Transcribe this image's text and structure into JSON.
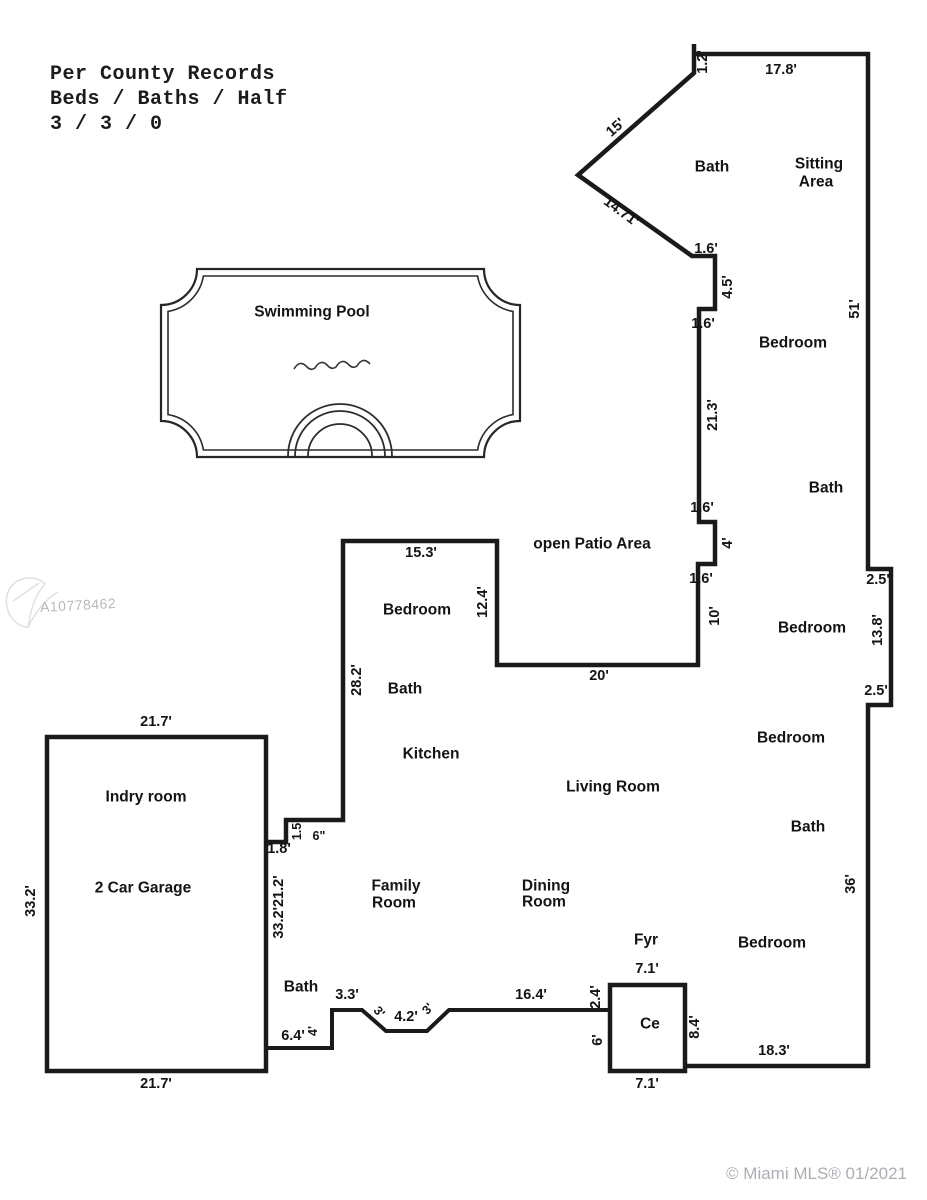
{
  "title_block": {
    "line1": "Per County Records",
    "line2": "Beds / Baths / Half",
    "line3": "3 / 3 / 0"
  },
  "watermark": {
    "mls_id": "A10778462"
  },
  "footer": {
    "copyright": "© Miami MLS® 01/2021"
  },
  "pool": {
    "label": "Swimming Pool"
  },
  "rooms": {
    "bath_top": "Bath",
    "sitting_area_line1": "Sitting",
    "sitting_area_line2": "Area",
    "bedroom_upper_right": "Bedroom",
    "bath_upper_right": "Bath",
    "open_patio": "open Patio Area",
    "bedroom_patio_wing": "Bedroom",
    "bath_patio_wing": "Bath",
    "bedroom_mid_right": "Bedroom",
    "bedroom_center_right": "Bedroom",
    "kitchen": "Kitchen",
    "living_room": "Living Room",
    "bath_lower_right": "Bath",
    "laundry": "Indry room",
    "garage": "2 Car Garage",
    "family_line1": "Family",
    "family_line2": "Room",
    "dining_line1": "Dining",
    "dining_line2": "Room",
    "foyer": "Fyr",
    "bedroom_bottom_right": "Bedroom",
    "closet": "Ce",
    "bath_bottom": "Bath"
  },
  "dims": {
    "nub_top": "1.2'",
    "top_width": "17.8'",
    "diag_upper": "15'",
    "diag_lower": "14.71'",
    "step1": "1.6'",
    "step1_depth": "4.5'",
    "step2": "1.6'",
    "right_upper": "51'",
    "wall_21_3": "21.3'",
    "step3": "1.6'",
    "step3_depth": "4'",
    "step4": "1.6'",
    "wall_10": "10'",
    "bump_top": "2.5'",
    "bump_side": "13.8'",
    "bump_bottom": "2.5'",
    "patio_top": "15.3'",
    "patio_side": "12.4'",
    "patio_bottom": "20'",
    "wall_28_2": "28.2'",
    "garage_top": "21.7'",
    "garage_side": "33.2'",
    "step_1_5": "1.5'",
    "step_6in": "6\"",
    "step_1_8": "1.8'",
    "interior_wall": "33.2'21.2'",
    "bath_3_3": "3.3'",
    "bath_diag_left": "3'",
    "bath_4_2": "4.2'",
    "bath_diag_right": "3'",
    "bath_16_4": "16.4'",
    "bath_6_4": "6.4'",
    "bath_4": "4'",
    "closet_left_upper": "2.4'",
    "closet_left_lower": "6'",
    "closet_top": "7.1'",
    "closet_right": "8.4'",
    "closet_bottom": "7.1'",
    "bottom_right": "18.3'",
    "garage_bottom": "21.7'",
    "right_lower": "36'"
  }
}
